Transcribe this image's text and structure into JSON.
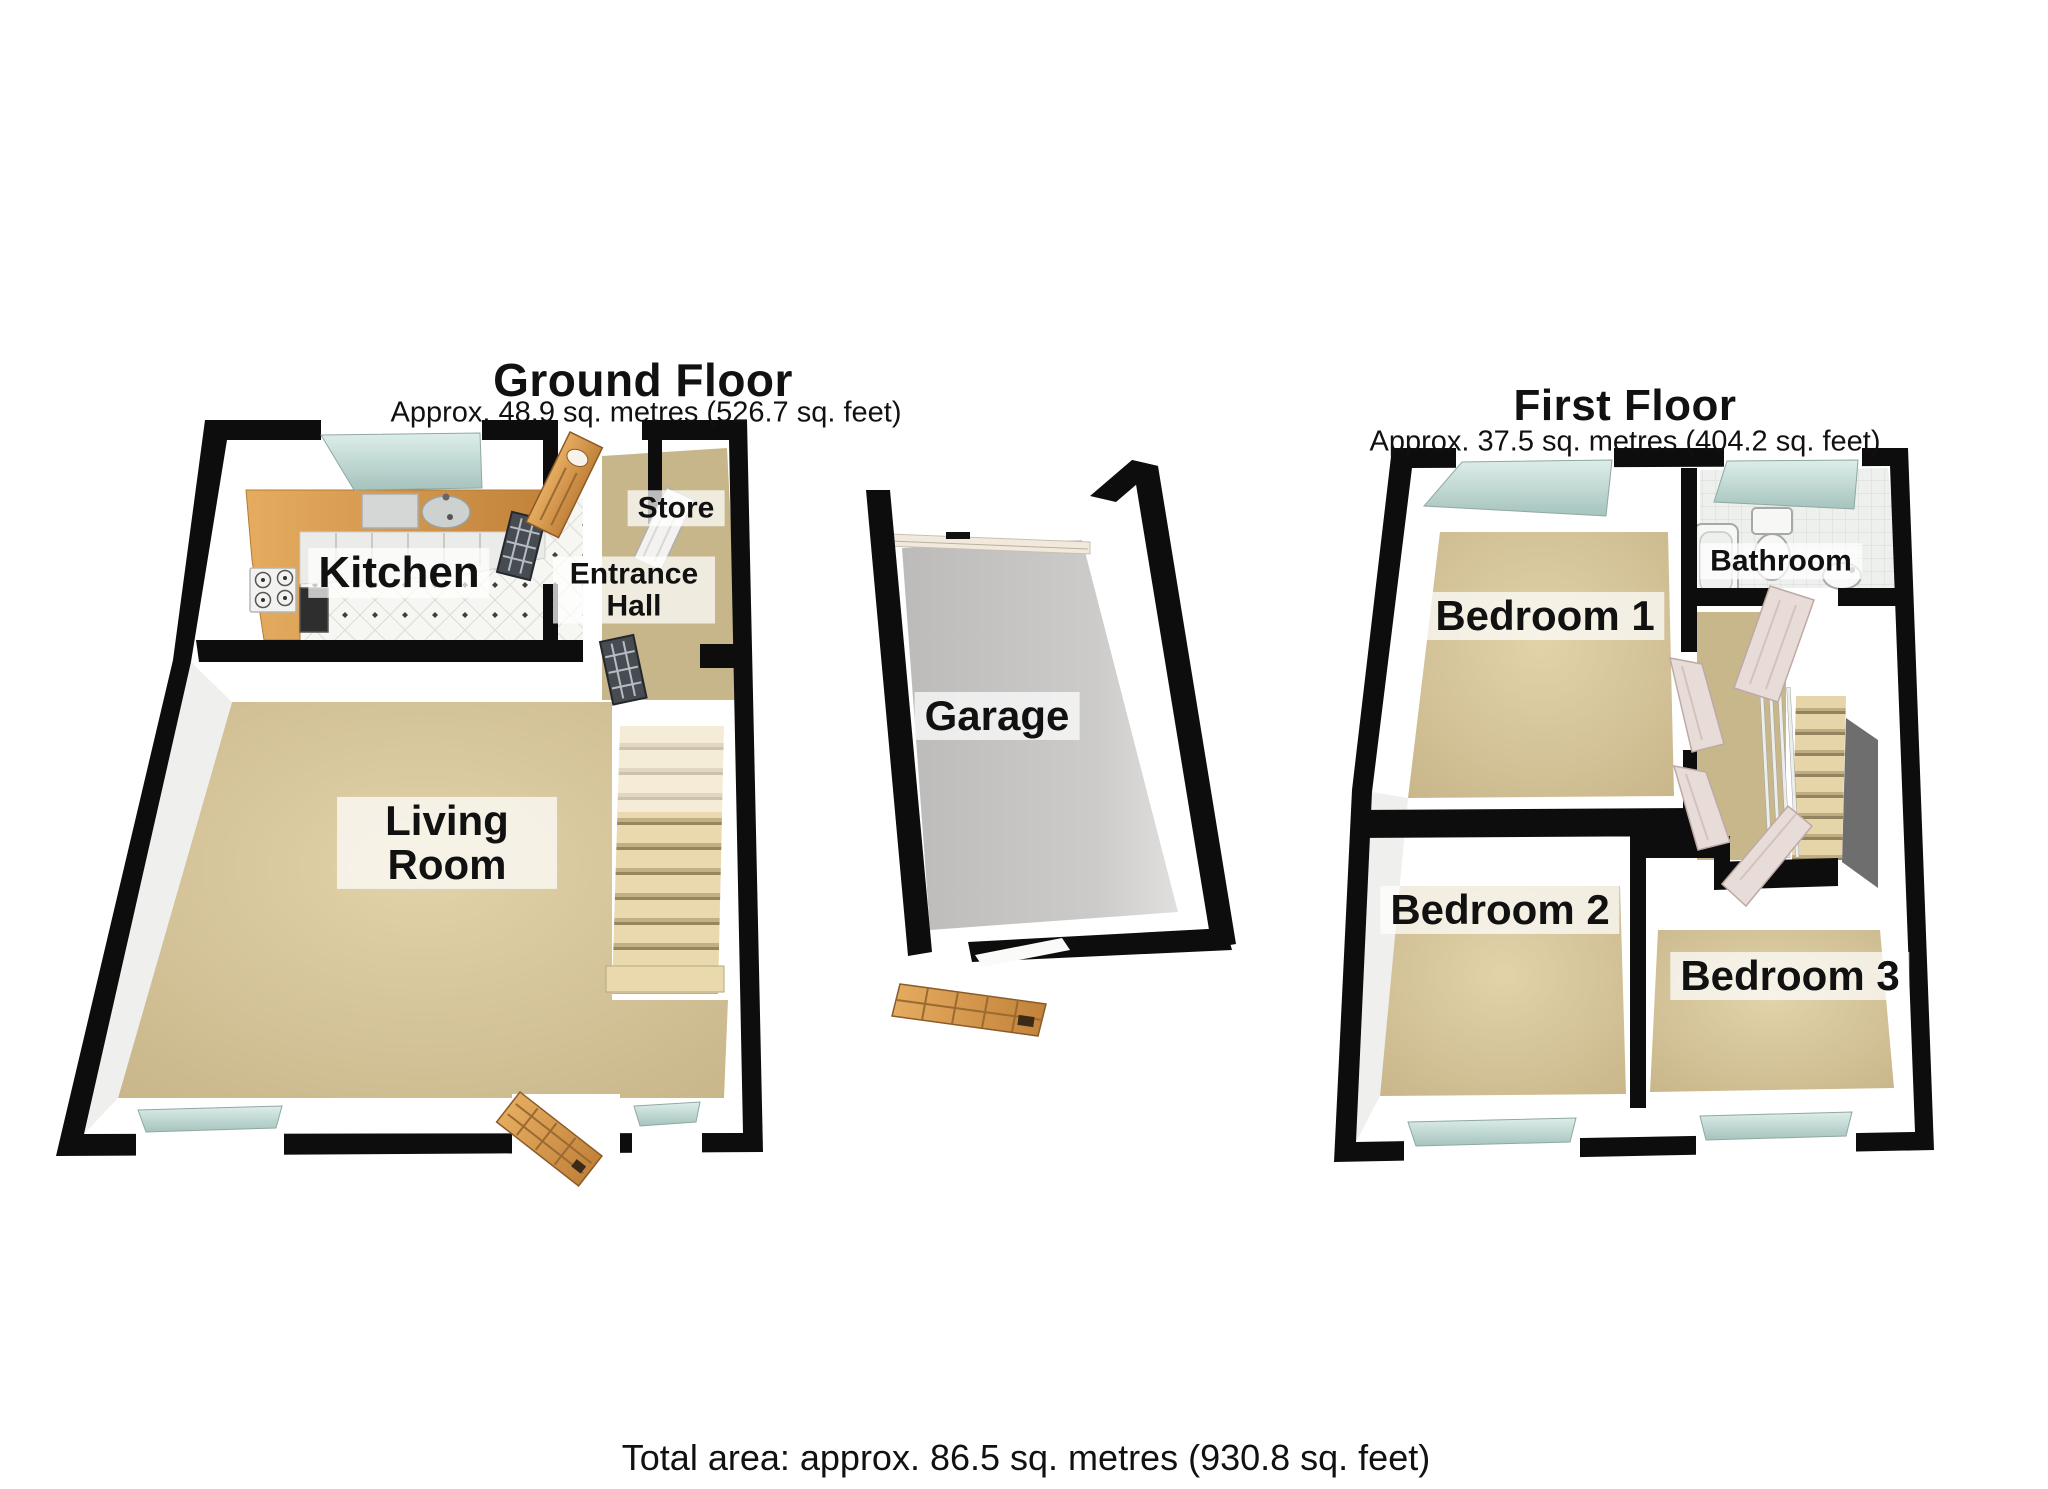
{
  "ground_floor": {
    "title": "Ground Floor",
    "subtitle": "Approx. 48.9 sq. metres (526.7 sq. feet)",
    "rooms": {
      "kitchen": "Kitchen",
      "store": "Store",
      "entrance_hall": "Entrance Hall",
      "living_room": "Living Room"
    }
  },
  "garage": {
    "label": "Garage"
  },
  "first_floor": {
    "title": "First Floor",
    "subtitle": "Approx. 37.5 sq. metres (404.2 sq. feet)",
    "rooms": {
      "bedroom_1": "Bedroom 1",
      "bathroom": "Bathroom",
      "bedroom_2": "Bedroom 2",
      "bedroom_3": "Bedroom 3"
    }
  },
  "footer": {
    "total_area": "Total area: approx. 86.5 sq. metres (930.8 sq. feet)"
  },
  "colors": {
    "wall": "#0d0d0d",
    "carpet": "#d6c49c",
    "hall_carpet": "#c8b68b",
    "kitchen_counter": "#dfa255",
    "window_glass": "#c9e1dd",
    "wood_door": "#d6994e",
    "garage_floor": "#c6c5c3",
    "stair_tread": "#e9d9ad",
    "bathroom_tile": "#edf0ee",
    "label_background": "rgba(255,255,255,0.72)",
    "text": "#111111"
  }
}
